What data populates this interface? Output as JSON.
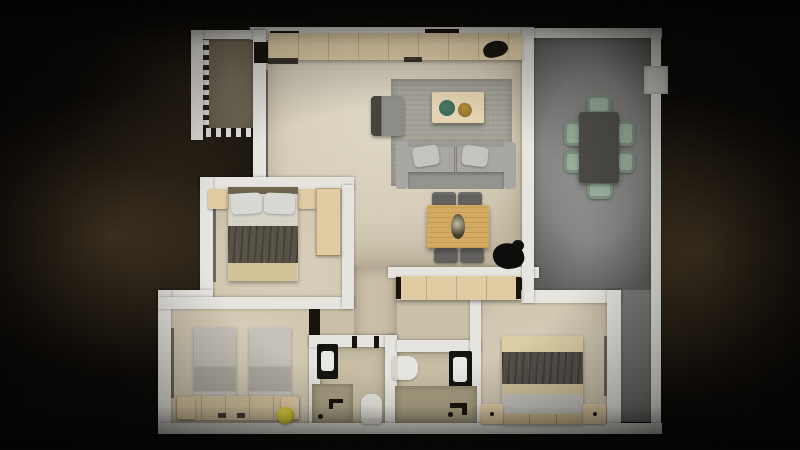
{
  "scene": {
    "kind": "3d-rendered-floor-plan",
    "view": "top-down",
    "lighting": "dark vignette with warm glow around apartment"
  },
  "rooms": [
    {
      "id": "balcony",
      "label": "balcony",
      "features": [
        "dashed open railing edge"
      ],
      "furniture": []
    },
    {
      "id": "kitchen",
      "label": "kitchen strip",
      "furniture": [
        "wood-counter",
        "dark-sink",
        "wall-vents",
        "entry-doorway"
      ]
    },
    {
      "id": "living-room",
      "label": "living room",
      "furniture": [
        "area-rug",
        "sofa-with-pillows",
        "armchair",
        "coffee-table",
        "green-plate",
        "gold-dish",
        "work-table",
        "four-chairs",
        "black-plant"
      ]
    },
    {
      "id": "terrace",
      "label": "gray terrace / dining room",
      "furniture": [
        "dark-dining-table",
        "six-sage-chairs",
        "ac-unit"
      ]
    },
    {
      "id": "bedroom-1",
      "label": "master bedroom",
      "furniture": [
        "double-bed-dark-blanket",
        "two-nightstands",
        "wardrobe"
      ]
    },
    {
      "id": "bedroom-2",
      "label": "twin bedroom",
      "furniture": [
        "twin-bed-a",
        "twin-bed-b",
        "headboard-shelf",
        "yellow-ball"
      ]
    },
    {
      "id": "bedroom-3",
      "label": "double bedroom",
      "furniture": [
        "double-bed-dark-blanket",
        "two-nightstands",
        "long-wardrobe"
      ]
    },
    {
      "id": "bathroom-1",
      "label": "bathroom",
      "furniture": [
        "black-vanity",
        "toilet",
        "shower-tray"
      ]
    },
    {
      "id": "bathroom-2",
      "label": "en-suite bathroom",
      "furniture": [
        "black-vanity",
        "toilet",
        "shower-tray"
      ]
    },
    {
      "id": "hallway",
      "label": "hallway",
      "furniture": []
    }
  ],
  "palette": {
    "wall": "#e8e7e2",
    "floorLiving": "#d8cfbb",
    "floorBedroom": "#d3c9b3",
    "floorHall": "#cbc1aa",
    "floorBath": "#c8bfa6",
    "floorShower": "#a9a083",
    "floorTerrace": "#878785",
    "floorBalcony": "#6e6452",
    "rug": "#a7a499",
    "sofa": "#96948f",
    "sofaLight": "#aaa8a4",
    "pillow": "#c6c5c1",
    "woodLight": "#e3cda5",
    "woodCounter": "#e6d2ac",
    "woodDesk": "#d6ac62",
    "woodCoffee": "#e7d6b4",
    "blanketDark": "#575247",
    "bedBase": "#d4c598",
    "headboardDark": "#6f654e",
    "twinBedLight": "#c8c4bc",
    "twinBedMid": "#b3afa6",
    "shelfWood": "#d9c9a3",
    "diningTable": "#4c4a45",
    "chairSage": "#9eb5a1",
    "chairGray": "#63615d",
    "vanityBlack": "#121210",
    "porcelain": "#eceae4",
    "toiletWhite": "#e8e7e1",
    "plantBlack": "#0c0c0a",
    "ballYellow": "#d6cd2b",
    "acWhite": "#d8d7d3",
    "goldItem": "#96742e",
    "plateGreen": "#33604f"
  }
}
